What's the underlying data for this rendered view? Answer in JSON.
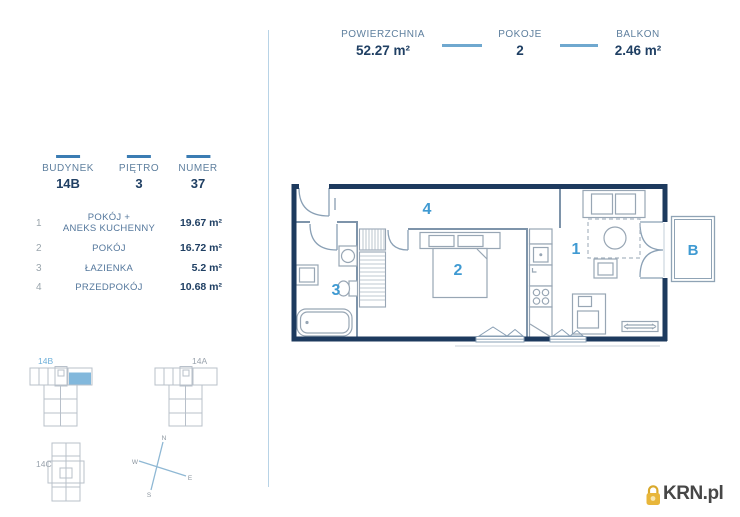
{
  "header": {
    "stats": [
      {
        "label": "POWIERZCHNIA",
        "value": "52.27 m²"
      },
      {
        "label": "POKOJE",
        "value": "2"
      },
      {
        "label": "BALKON",
        "value": "2.46 m²"
      }
    ]
  },
  "unit": {
    "fields": [
      {
        "label": "BUDYNEK",
        "value": "14B"
      },
      {
        "label": "PIĘTRO",
        "value": "3"
      },
      {
        "label": "NUMER",
        "value": "37"
      }
    ],
    "rooms": [
      {
        "num": "1",
        "name": "POKÓJ +\nANEKS KUCHENNY",
        "area": "19.67 m²"
      },
      {
        "num": "2",
        "name": "POKÓJ",
        "area": "16.72 m²"
      },
      {
        "num": "3",
        "name": "ŁAZIENKA",
        "area": "5.2 m²"
      },
      {
        "num": "4",
        "name": "PRZEDPOKÓJ",
        "area": "10.68 m²"
      }
    ]
  },
  "plan": {
    "labels": {
      "room1": "1",
      "room2": "2",
      "room3": "3",
      "room4": "4",
      "balcony": "B"
    }
  },
  "site_plan": {
    "buildings": [
      {
        "name": "14B",
        "highlighted": true
      },
      {
        "name": "14A",
        "highlighted": false
      },
      {
        "name": "14C",
        "highlighted": false
      }
    ],
    "compass": {
      "n": "N",
      "e": "E",
      "s": "S",
      "w": "W"
    }
  },
  "logo": {
    "text": "KRN.pl"
  },
  "colors": {
    "wall_navy": "#1d3a5e",
    "accent_blue": "#3f9ad2",
    "label_blue": "#5e7f9e",
    "value_navy": "#1f3f63",
    "separator_blue": "#6fa8cf",
    "tick_blue": "#3b7cb3",
    "unit_highlight": "#82b8dc",
    "logo_gold": "#e8b63a"
  }
}
